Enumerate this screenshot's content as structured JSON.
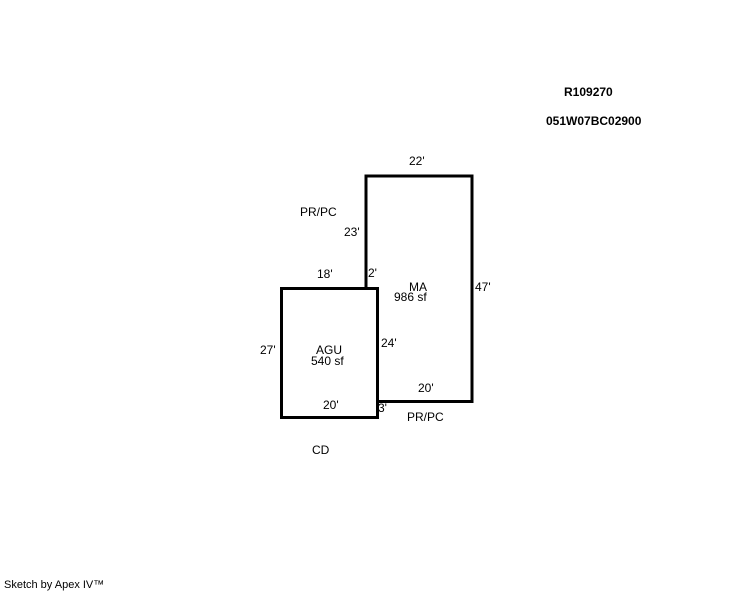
{
  "header": {
    "record_number": "R109270",
    "parcel_number": "051W07BC02900"
  },
  "sketch": {
    "ma": {
      "code": "MA",
      "area": "986 sf",
      "dim_top": "22'",
      "dim_right": "47'",
      "dim_bottom": "20'",
      "dim_left_upper": "23'",
      "dim_jog": "2'",
      "dim_bottom_offset": "3'"
    },
    "agu": {
      "code": "AGU",
      "area": "540 sf",
      "dim_top": "18'",
      "dim_left": "27'",
      "dim_bottom": "20'",
      "dim_right": "24'"
    },
    "annotations": {
      "porch_top": "PR/PC",
      "porch_bottom": "PR/PC",
      "cd": "CD"
    },
    "colors": {
      "line": "#000000",
      "background": "#ffffff"
    }
  },
  "footer": {
    "credit": "Sketch by Apex IV™"
  }
}
